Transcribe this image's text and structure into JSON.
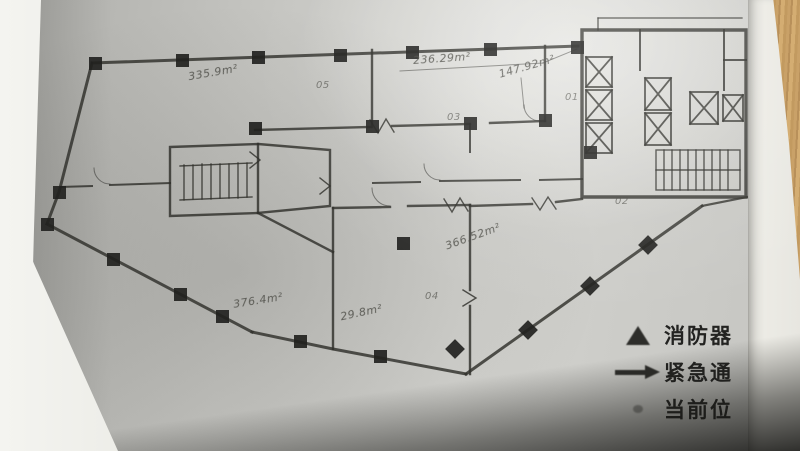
{
  "annotations": [
    {
      "text": "335.9m²"
    },
    {
      "text": "05"
    },
    {
      "text": "236.29m²"
    },
    {
      "text": "147.92m²"
    },
    {
      "text": "01"
    },
    {
      "text": "03"
    },
    {
      "text": "02"
    },
    {
      "text": "366.52m²"
    },
    {
      "text": "04"
    },
    {
      "text": "376.4m²"
    },
    {
      "text": "29.8m²"
    }
  ],
  "legend": {
    "items": [
      {
        "icon": "fire-extinguisher-triangle-icon",
        "label": "消防器"
      },
      {
        "icon": "emergency-route-arrow-icon",
        "label": "紧急通"
      },
      {
        "icon": "current-location-icon",
        "label": "当前位"
      }
    ]
  },
  "colors": {
    "paper": "#c5c5c1",
    "ink": "#2f2f2b",
    "pencil": "#4c4c46",
    "wood": "#c9a168",
    "legend_text": "#232321"
  }
}
